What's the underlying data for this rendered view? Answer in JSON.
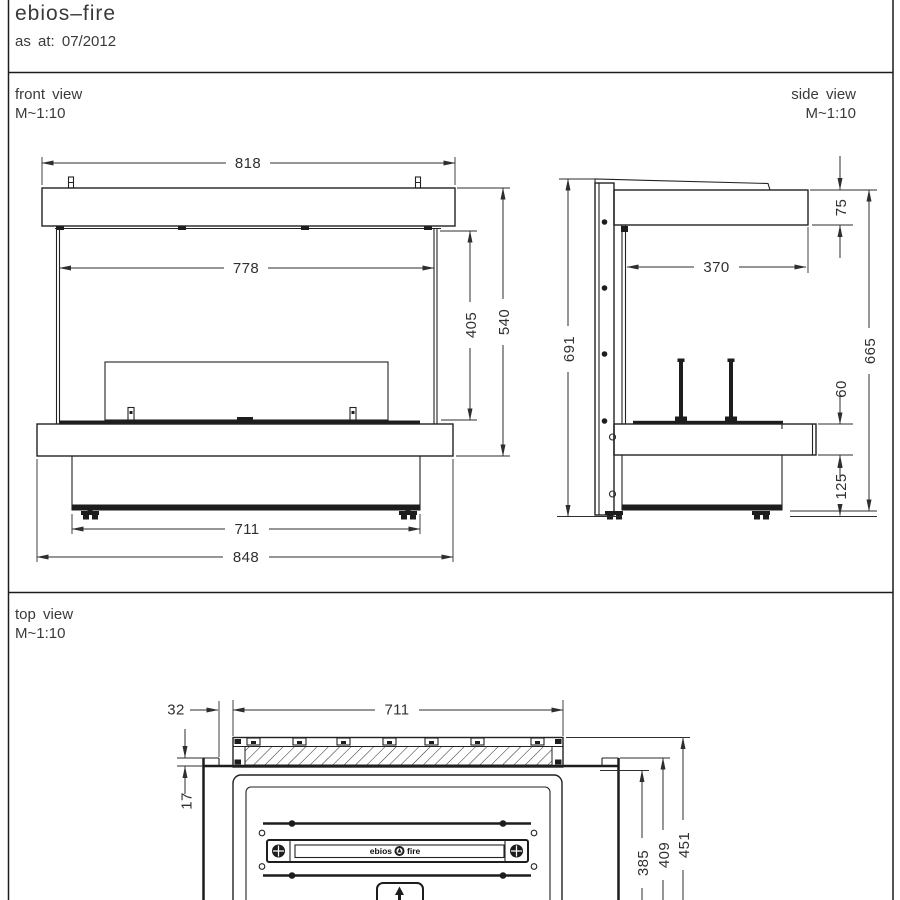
{
  "header": {
    "title": "ebios–fire",
    "issue": "as at: 07/2012"
  },
  "views": {
    "front": {
      "label": "front view",
      "scale": "M~1:10",
      "dims": {
        "top_width": "818",
        "opening_width": "778",
        "opening_height": "405",
        "total_height": "540",
        "base_width": "711",
        "overall_width": "848"
      }
    },
    "side": {
      "label": "side view",
      "scale": "M~1:10",
      "dims": {
        "cap_height": "75",
        "inner_depth": "370",
        "back_height": "691",
        "front_height": "665",
        "bench_thickness": "60",
        "base_height": "125"
      }
    },
    "top": {
      "label": "top view",
      "scale": "M~1:10",
      "dims": {
        "side_offset": "32",
        "glass_length": "711",
        "glass_offset": "17",
        "depth_inner": "385",
        "depth_mid": "409",
        "depth_outer": "451"
      }
    }
  },
  "burner": {
    "brand_left": "ebios",
    "brand_right": "fire"
  },
  "colors": {
    "ink": "#1d1d1d",
    "dim_ink": "#2e2e2e",
    "paper": "#ffffff"
  }
}
